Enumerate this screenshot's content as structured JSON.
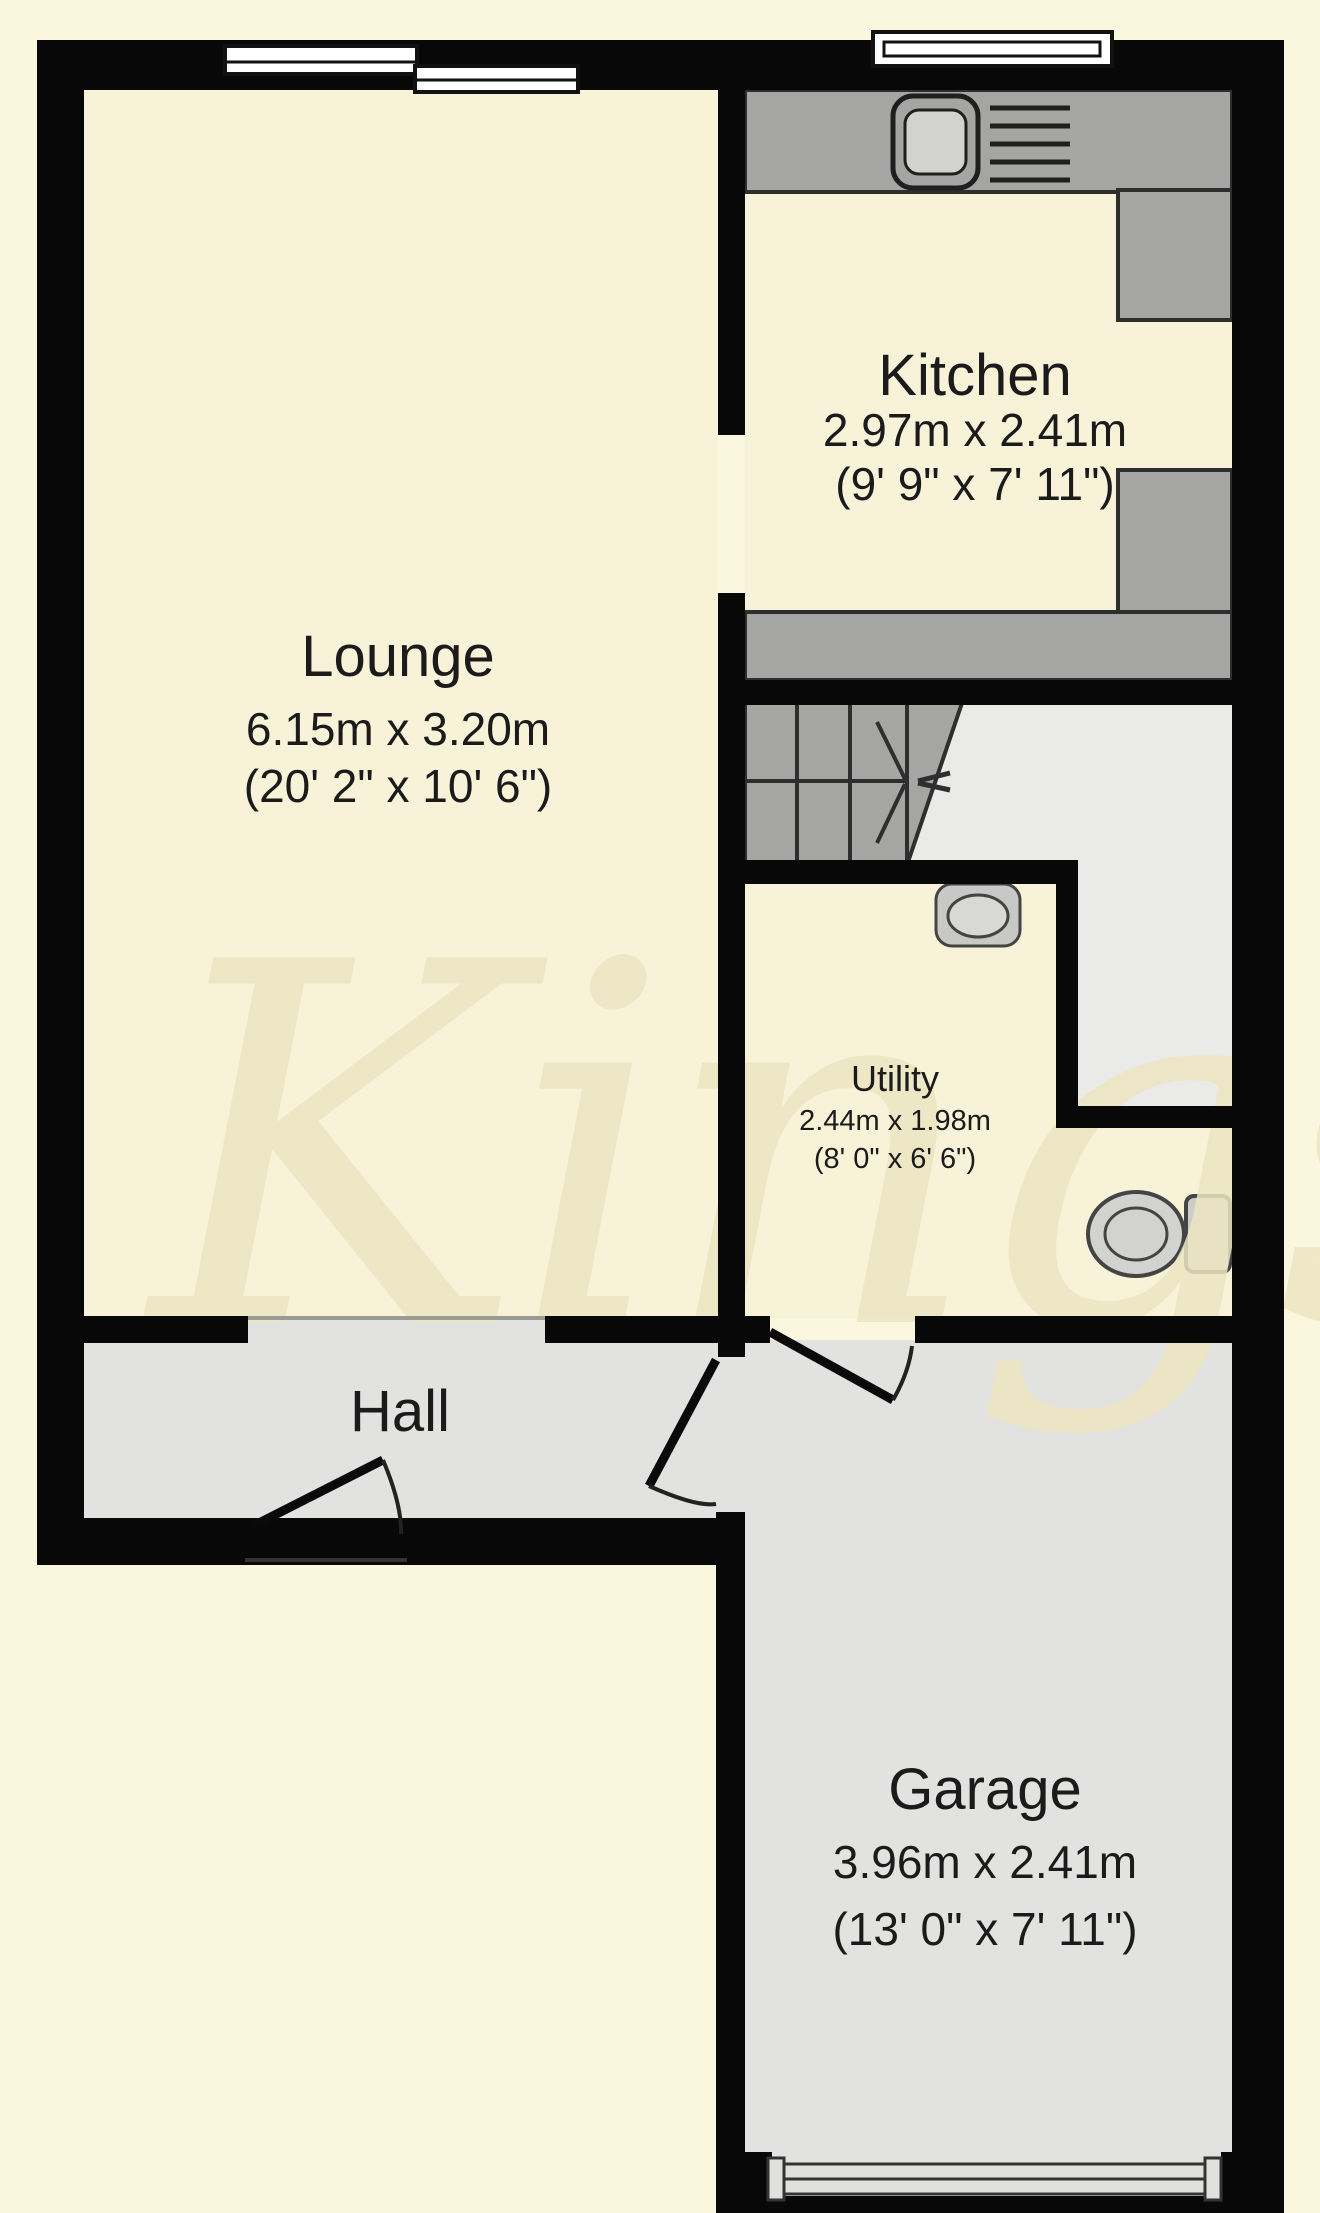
{
  "floorplan": {
    "type": "ground-floor-plan",
    "watermark": "Kings",
    "rooms": [
      {
        "id": "lounge",
        "name": "Lounge",
        "metric": "6.15m x 3.20m",
        "imperial": "(20' 2\" x 10' 6\")"
      },
      {
        "id": "kitchen",
        "name": "Kitchen",
        "metric": "2.97m x 2.41m",
        "imperial": "(9' 9\" x 7' 11\")"
      },
      {
        "id": "utility",
        "name": "Utility",
        "metric": "2.44m x 1.98m",
        "imperial": "(8' 0\" x 6' 6\")"
      },
      {
        "id": "hall",
        "name": "Hall"
      },
      {
        "id": "garage",
        "name": "Garage",
        "metric": "3.96m x 2.41m",
        "imperial": "(13' 0\" x 7' 11\")"
      }
    ],
    "fixtures": [
      "kitchen-sink",
      "kitchen-drainer",
      "utility-sink",
      "toilet",
      "staircase"
    ],
    "colors": {
      "page_background": "#FBF7DF",
      "room_floor_cream": "#F8F3D8",
      "hall_garage_floor": "#E2E2E0",
      "landing_floor": "#EAEAE8",
      "counter_stairs_gray": "#A5A5A3",
      "wall_black": "#080808",
      "watermark_tan": "#EDE6C2",
      "label_text": "#1B1B1B"
    }
  }
}
